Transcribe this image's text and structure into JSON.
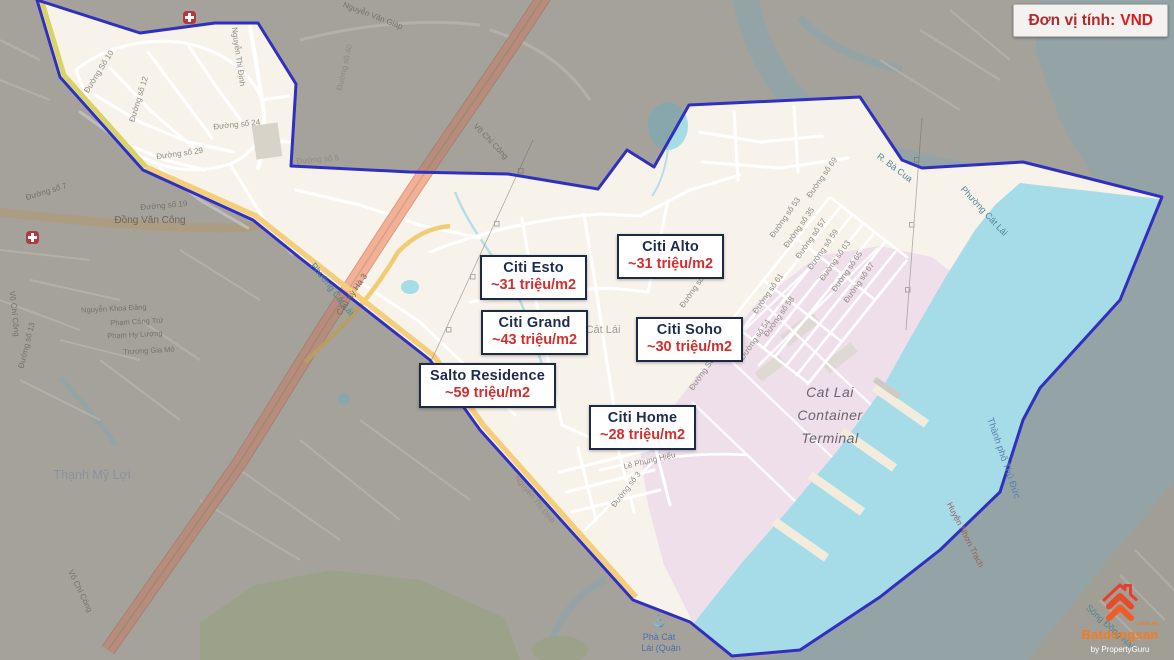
{
  "badge": {
    "label": "Đơn vị tính:",
    "value": "VND"
  },
  "listings": [
    {
      "id": "citi-esto",
      "name": "Citi Esto",
      "price": "~31 triệu/m2"
    },
    {
      "id": "citi-alto",
      "name": "Citi Alto",
      "price": "~31 triệu/m2"
    },
    {
      "id": "citi-grand",
      "name": "Citi Grand",
      "price": "~43 triệu/m2"
    },
    {
      "id": "citi-soho",
      "name": "Citi Soho",
      "price": "~30 triệu/m2"
    },
    {
      "id": "salto-residence",
      "name": "Salto Residence",
      "price": "~59 triệu/m2"
    },
    {
      "id": "citi-home",
      "name": "Citi Home",
      "price": "~28 triệu/m2"
    }
  ],
  "map_labels": {
    "cat_lai_terminal": [
      "Cat Lai",
      "Container",
      "Terminal"
    ],
    "cat_lai_area": "Cát Lái",
    "thanh_my_loi": "Thạnh Mỹ Lợi",
    "dong_van_cong": "Đồng Văn Công",
    "vo_chi_cong": "Võ Chí Công",
    "vo_chi_cong_2": "Võ Chí Công",
    "vo_chi_cong_3": "Võ Chí Công",
    "nguyen_van_giap": "Nguyễn Văn Giáp",
    "nguyen_thi_dinh": "Nguyễn Thị Định",
    "nguyen_thi_dinh_2": "Nguyễn Thị Định",
    "cau_ky_ha_3": "Cầu Kỳ Hà 3",
    "r_ba_cua": "R. Bà Cua",
    "phuong_cat_lai": "Phường Cát Lái",
    "phuong_cat_lai_2": "Phường Cát Lái",
    "thanh_pho_thu_duc": "Thành phố Thủ Đức",
    "song_dong_nai": "Sông Đồng Nai",
    "huyen_nhon_trach": "Huyện Nhơn Trạch",
    "pha_cat_lai_line1": "Phà Cát",
    "pha_cat_lai_line2": "Lái (Quận",
    "le_phung_hieu": "Lê Phụng Hiểu",
    "duong_so_3": "Đường số 3",
    "duong_so_5": "Đường số 5",
    "duong_so_7": "Đường số 7",
    "duong_so_10": "Đường Số 10",
    "duong_so_12": "Đường số 12",
    "duong_so_13": "Đường số 13",
    "duong_so_18": "Đường Số 18",
    "duong_so_19": "Đường số 19",
    "duong_so_23": "Đường số 23",
    "duong_so_24": "Đường số 24",
    "duong_so_29": "Đường số 29",
    "duong_so_35": "Đường số 35",
    "duong_so_40": "Đường số 40",
    "duong_so_53": "Đường số 53",
    "duong_so_54": "Đường số 54",
    "duong_so_57": "Đường số 57",
    "duong_so_58": "Đường số 58",
    "duong_so_59": "Đường số 59",
    "duong_so_61": "Đường số 61",
    "duong_so_63": "Đường số 63",
    "duong_so_65": "Đường số 65",
    "duong_so_67": "Đường số 67",
    "duong_so_69": "Đường số 69",
    "nguyen_khoa_dang": "Nguyễn Khoa Đăng",
    "pham_cong_tru": "Phạm Công Trứ",
    "pham_hy_luong": "Phạm Hy Lượng",
    "truong_gia_mo": "Trương Gia Mô"
  },
  "icons": {
    "anchor": "⚓"
  },
  "logo": {
    "brand": "Batdongsan",
    "suffix": ".com.vn",
    "byline": "by PropertyGuru"
  },
  "colors": {
    "boundary": "#3030c0",
    "price_red": "#d32f2f",
    "title_navy": "#1d2c4e",
    "badge_red": "#c1272d",
    "highway_salmon": "#f2b096",
    "water_cyan": "#a6dbe8",
    "terminal_pink": "#eedfeb",
    "logo_orange": "#f47b20"
  }
}
